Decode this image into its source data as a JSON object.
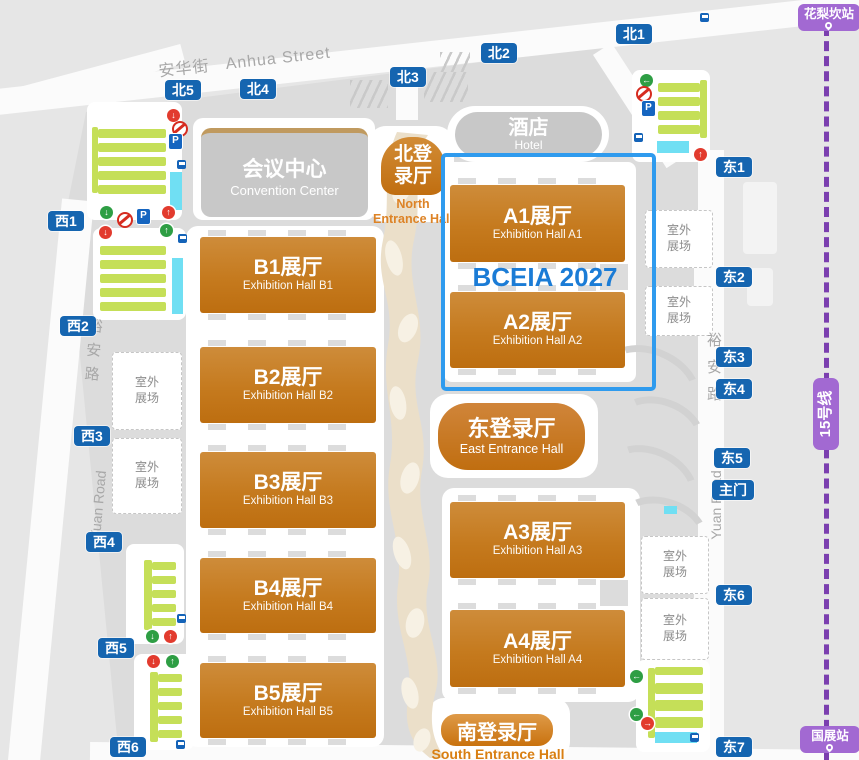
{
  "map": {
    "streets": {
      "anhua": {
        "zh": "安华街",
        "en": "Anhua Street"
      },
      "yuan_west": {
        "zh": "裕安路",
        "en": "Yuan Road"
      },
      "yuan_east": {
        "zh": "裕安路",
        "en": "Yuan Road"
      }
    },
    "metro": {
      "line_label": "15号线",
      "station_north": "花梨坎站",
      "station_south": "国展站"
    },
    "event_label": "BCEIA 2027",
    "buildings": {
      "convention": {
        "zh": "会议中心",
        "en": "Convention Center"
      },
      "hotel": {
        "zh": "酒店",
        "en": "Hotel"
      }
    },
    "entrances": {
      "north": {
        "zh1": "北登",
        "zh2": "录厅",
        "en1": "North",
        "en2": "Entrance Hall"
      },
      "east": {
        "zh": "东登录厅",
        "en": "East Entrance Hall"
      },
      "south": {
        "zh": "南登录厅",
        "en": "South Entrance Hall"
      }
    },
    "halls_a": [
      {
        "zh": "A1展厅",
        "en": "Exhibition Hall A1"
      },
      {
        "zh": "A2展厅",
        "en": "Exhibition Hall A2"
      },
      {
        "zh": "A3展厅",
        "en": "Exhibition Hall A3"
      },
      {
        "zh": "A4展厅",
        "en": "Exhibition Hall A4"
      }
    ],
    "halls_b": [
      {
        "zh": "B1展厅",
        "en": "Exhibition Hall B1"
      },
      {
        "zh": "B2展厅",
        "en": "Exhibition Hall B2"
      },
      {
        "zh": "B3展厅",
        "en": "Exhibition Hall B3"
      },
      {
        "zh": "B4展厅",
        "en": "Exhibition Hall B4"
      },
      {
        "zh": "B5展厅",
        "en": "Exhibition Hall B5"
      }
    ],
    "gates_north": [
      "北1",
      "北2",
      "北3",
      "北4",
      "北5"
    ],
    "gates_west": [
      "西1",
      "西2",
      "西3",
      "西4",
      "西5",
      "西6"
    ],
    "gates_east": [
      "东1",
      "东2",
      "东3",
      "东4",
      "东5",
      "东6",
      "东7"
    ],
    "gate_main": "主门",
    "outdoor": {
      "line1": "室外",
      "line2": "展场"
    },
    "colors": {
      "gate_badge_blue": "#1565B0",
      "hall_orange_top": "#CE8C3A",
      "hall_orange_bottom": "#BD6E10",
      "event_blue": "#1B7CD6",
      "highlight_box_blue": "#2F9BEE",
      "metro_purple": "#7B3FAF",
      "metro_badge_purple": "#A269D2",
      "parking_green": "#C5DF58",
      "drop_zone_cyan": "#70DFF3",
      "walkway_tan": "#EBDFC9"
    }
  }
}
